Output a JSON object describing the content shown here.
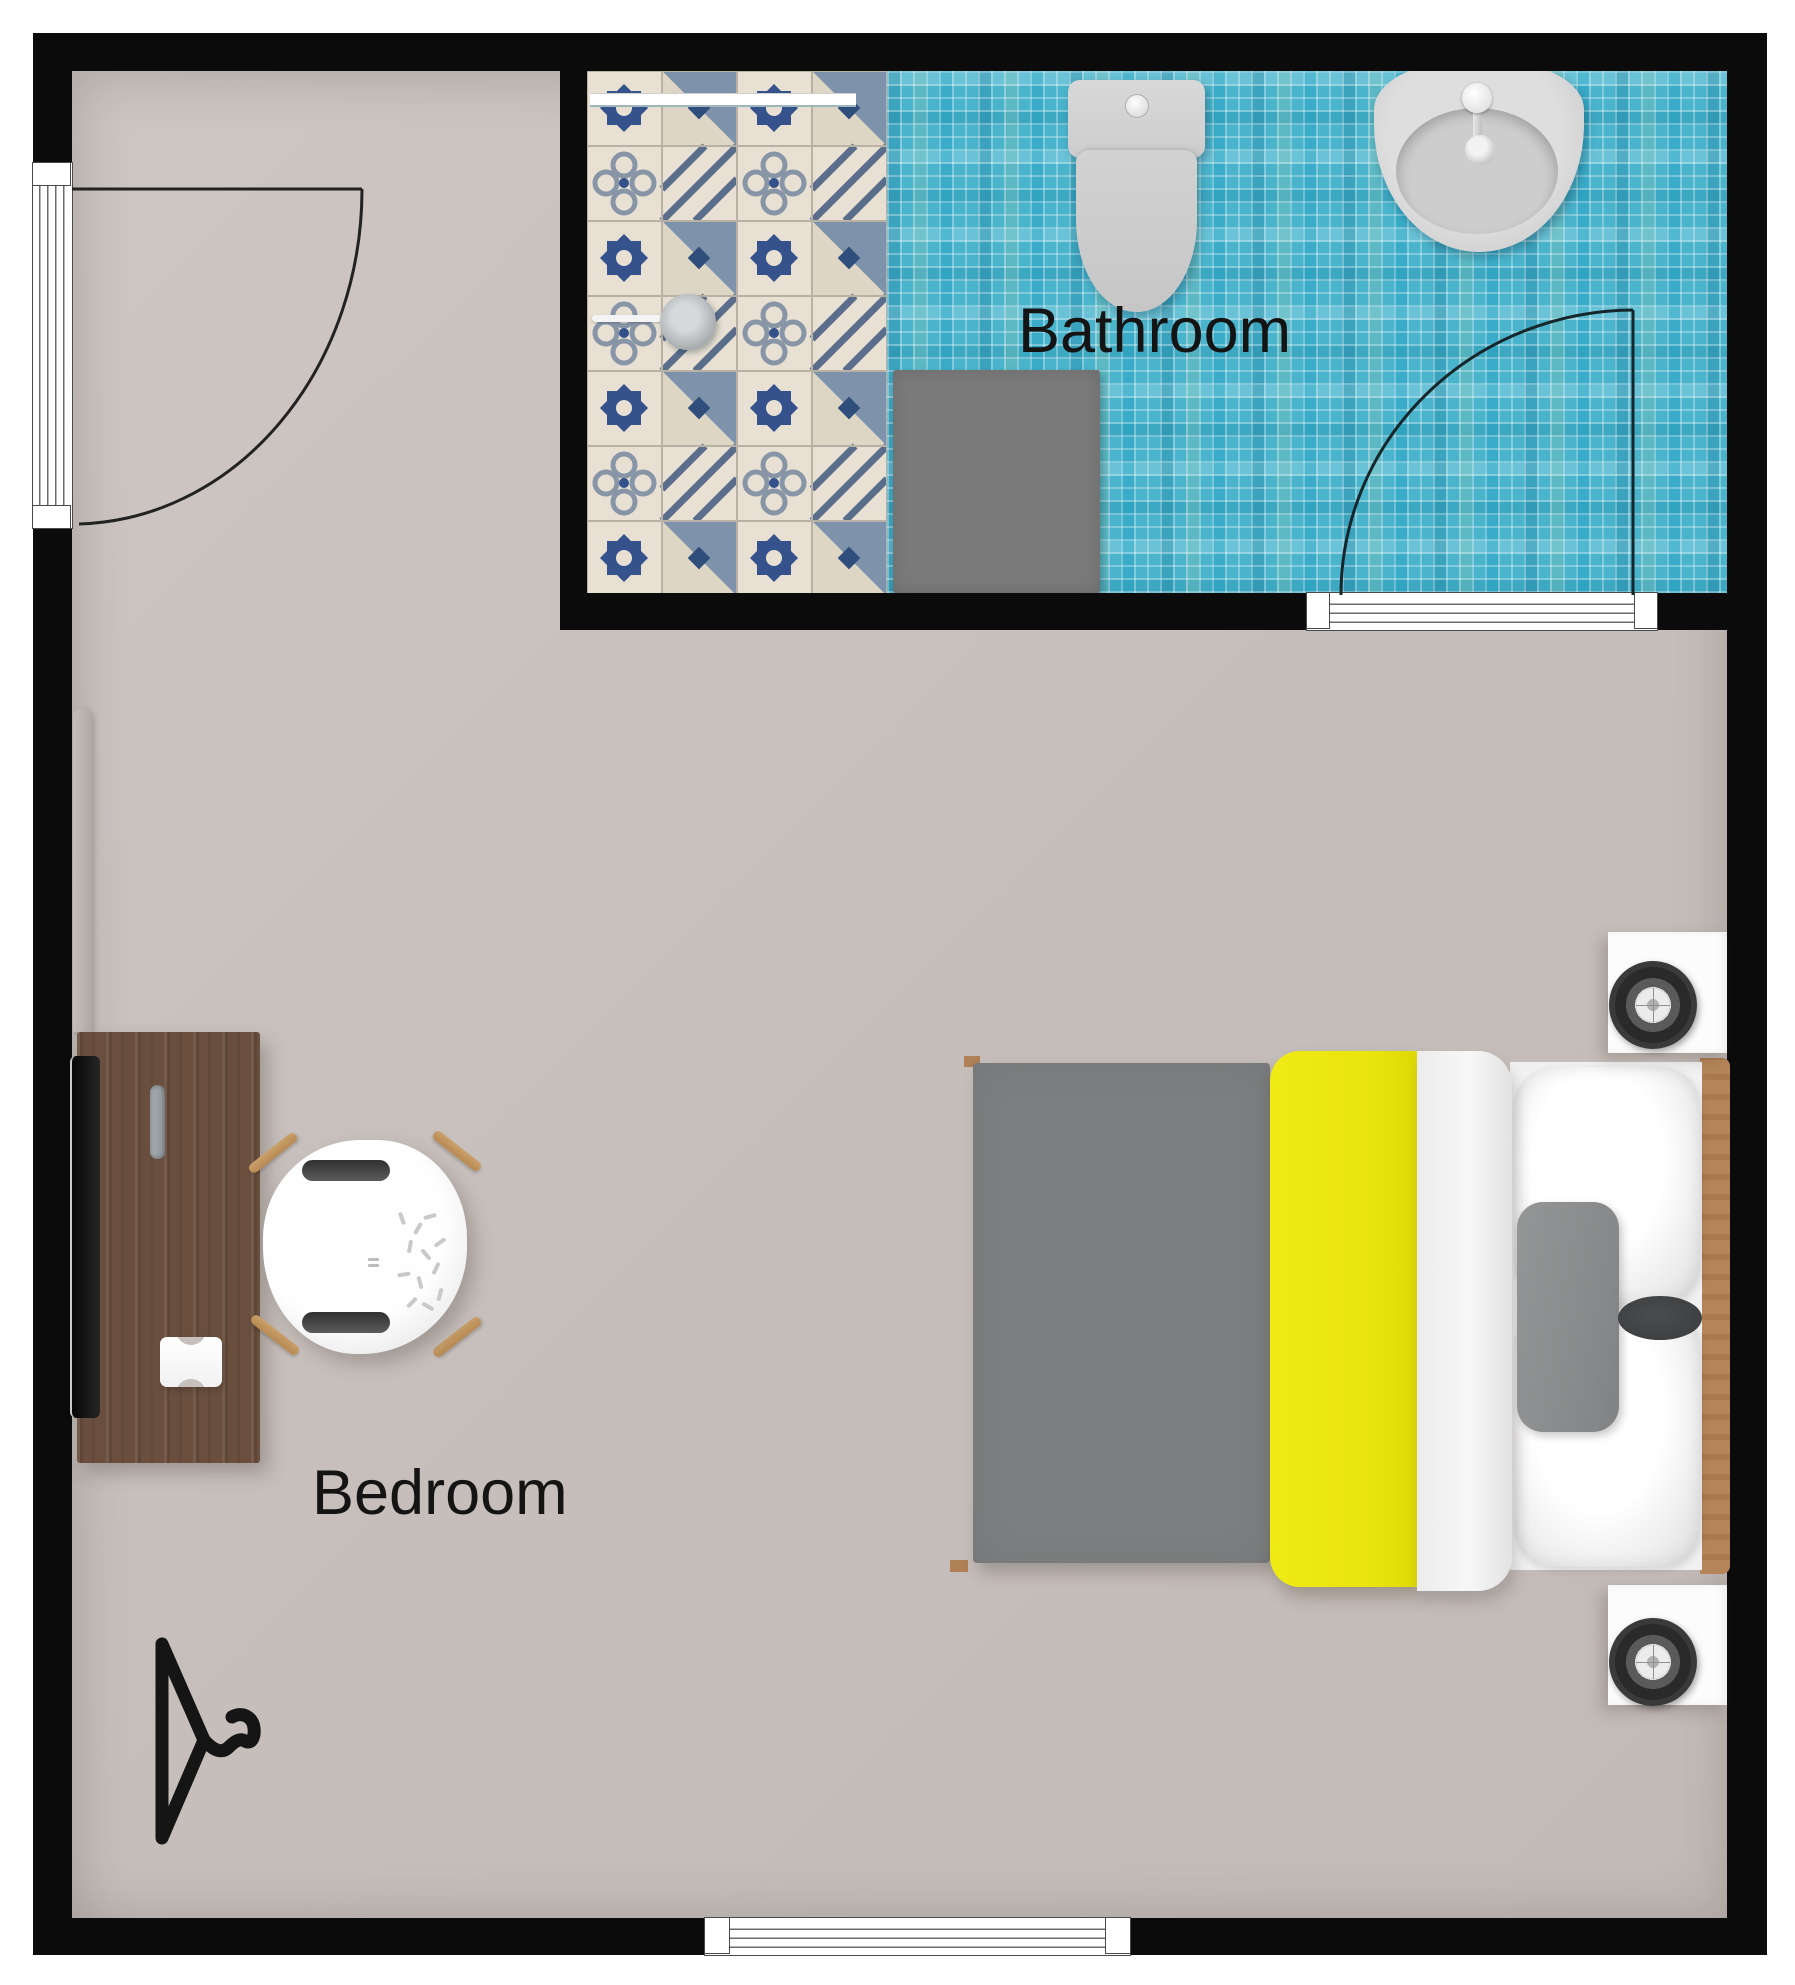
{
  "labels": {
    "bathroom": "Bathroom",
    "bedroom": "Bedroom"
  },
  "rooms": [
    {
      "label": "Bathroom",
      "floor": "blue mosaic tile with patterned encaustic tile shower zone"
    },
    {
      "label": "Bedroom",
      "floor": "beige"
    }
  ],
  "fixtures": {
    "bathroom": [
      "shower-area",
      "shower-head",
      "shower-screen",
      "toilet",
      "sink",
      "bath-mat",
      "swing-door"
    ],
    "bedroom": [
      "double-bed",
      "nightstand-with-speaker",
      "nightstand-with-speaker",
      "desk",
      "monitor",
      "pencil-tray",
      "desk-chair",
      "wall-shelf-panel",
      "clothes-hanger",
      "entry-door",
      "window"
    ]
  },
  "colors": {
    "wall": "#0b0b0b",
    "bedroom_floor": "#c7bfbb",
    "bathroom_mosaic": "#4ab4cd",
    "shower_tile_base": "#e8e1d3",
    "blanket_yellow": "#e9e40b",
    "duvet_gray": "#7c7e7f",
    "pillow_gray": "#8c8e8f",
    "bath_mat": "#7a7a7a",
    "desk_wood": "#6a4f3e",
    "headboard_wood": "#b58559",
    "chair_leg_wood": "#c2965f",
    "label_text": "#141414"
  }
}
